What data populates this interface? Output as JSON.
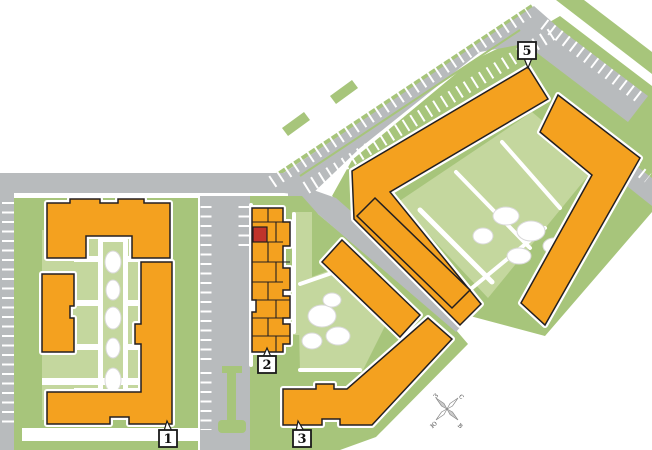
{
  "site_plan": {
    "buildings": [
      {
        "id": "1",
        "label": "1"
      },
      {
        "id": "2",
        "label": "2"
      },
      {
        "id": "3",
        "label": "3"
      },
      {
        "id": "5",
        "label": "5"
      }
    ],
    "selected_section": {
      "building": "2",
      "color": "#c0332b"
    },
    "compass": {
      "north": "с",
      "south": "ю",
      "west": "з",
      "east": "в"
    },
    "colors": {
      "building": "#f4a11f",
      "building_outline": "#231f20",
      "selected": "#c0332b",
      "road": "#b8bbbd",
      "green": "#a7c57b",
      "green_light": "#c4d79e",
      "background": "#ffffff"
    }
  }
}
